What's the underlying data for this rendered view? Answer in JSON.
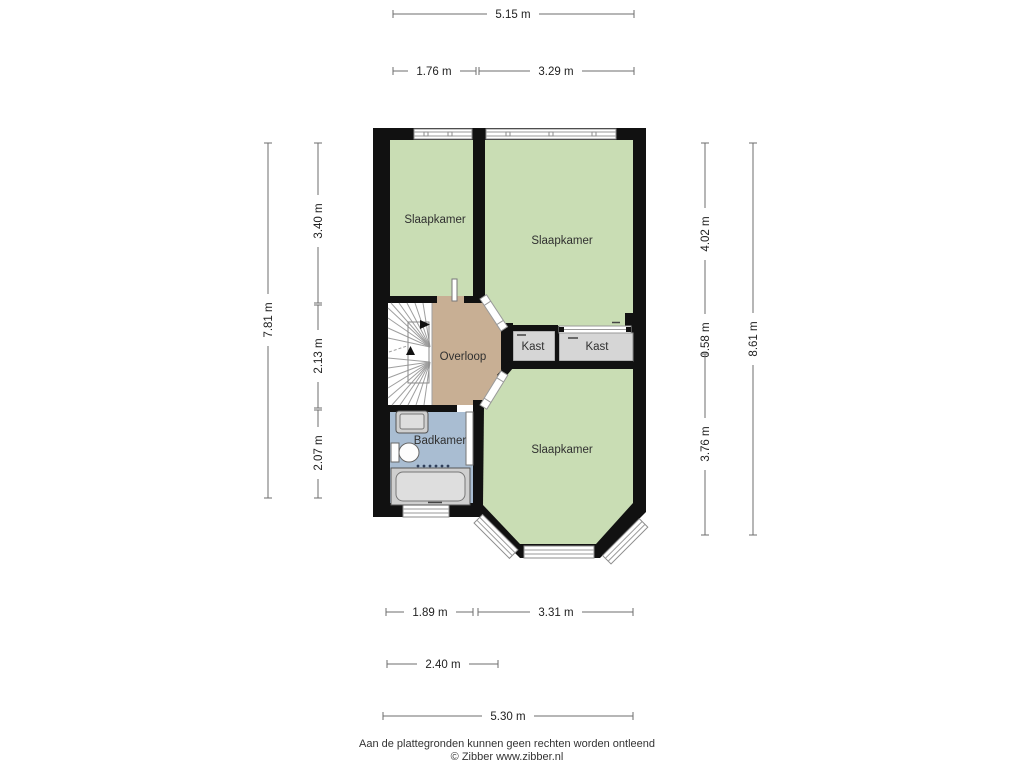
{
  "floorplan": {
    "rooms": {
      "bedroom_top_left": {
        "label": "Slaapkamer"
      },
      "bedroom_top_right": {
        "label": "Slaapkamer"
      },
      "bedroom_bottom": {
        "label": "Slaapkamer"
      },
      "landing": {
        "label": "Overloop"
      },
      "closet_left": {
        "label": "Kast"
      },
      "closet_right": {
        "label": "Kast"
      },
      "bathroom": {
        "label": "Badkamer"
      }
    },
    "dimensions": {
      "top_total": {
        "label": "5.15 m"
      },
      "top_left": {
        "label": "1.76 m"
      },
      "top_right": {
        "label": "3.29 m"
      },
      "left_total": {
        "label": "7.81 m"
      },
      "left_seg1": {
        "label": "3.40 m"
      },
      "left_seg2": {
        "label": "2.13 m"
      },
      "left_seg3": {
        "label": "2.07 m"
      },
      "right_seg1": {
        "label": "4.02 m"
      },
      "right_seg2": {
        "label": "0.58 m"
      },
      "right_seg3": {
        "label": "3.76 m"
      },
      "right_total": {
        "label": "8.61 m"
      },
      "bottom_left": {
        "label": "1.89 m"
      },
      "bottom_right": {
        "label": "3.31 m"
      },
      "bottom_mid": {
        "label": "2.40 m"
      },
      "bottom_total": {
        "label": "5.30 m"
      }
    },
    "footer": {
      "disclaimer": "Aan de plattegronden kunnen geen rechten worden ontleend",
      "credit": "© Zibber www.zibber.nl"
    },
    "colors": {
      "room_green": "#c9ddb4",
      "landing_tan": "#c8af94",
      "bathroom_blue": "#a9bdd2",
      "closet_gray": "#d6d6d6",
      "wall_black": "#111111"
    }
  }
}
